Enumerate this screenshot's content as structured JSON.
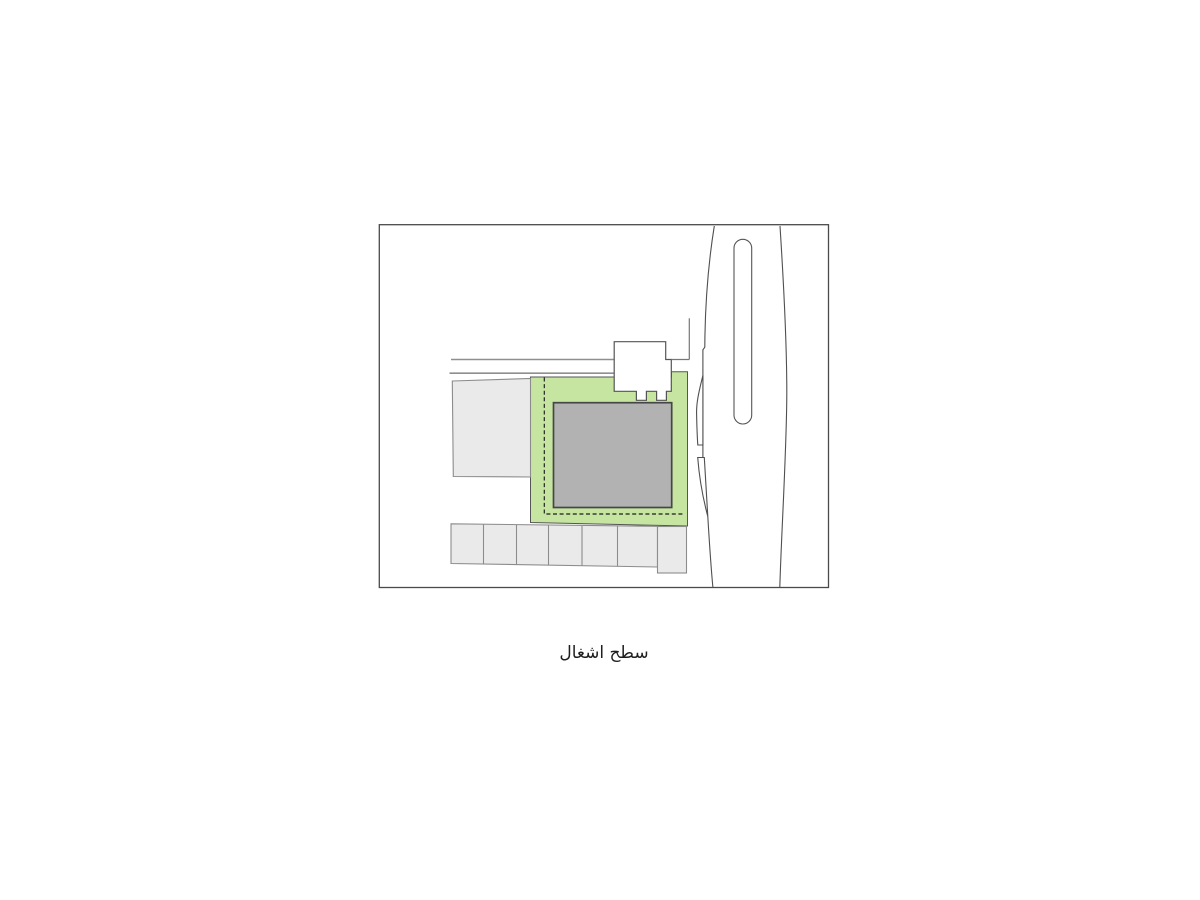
{
  "caption": {
    "text": "سطح اشغال"
  },
  "colors": {
    "background": "#ffffff",
    "parcel_green": "#c6e5a0",
    "parcel_outline": "#555555",
    "building_gray": "#b2b2b2",
    "building_outline": "#464646",
    "neighbor_gray": "#eaeaea",
    "neighbor_outline": "#8c8c8c",
    "frame_outline": "#4a4a4a",
    "street_edge_gray": "#8f8f8f",
    "road_line_gray": "#4f4f4f",
    "setback_dash_black": "#1c1c1c"
  }
}
